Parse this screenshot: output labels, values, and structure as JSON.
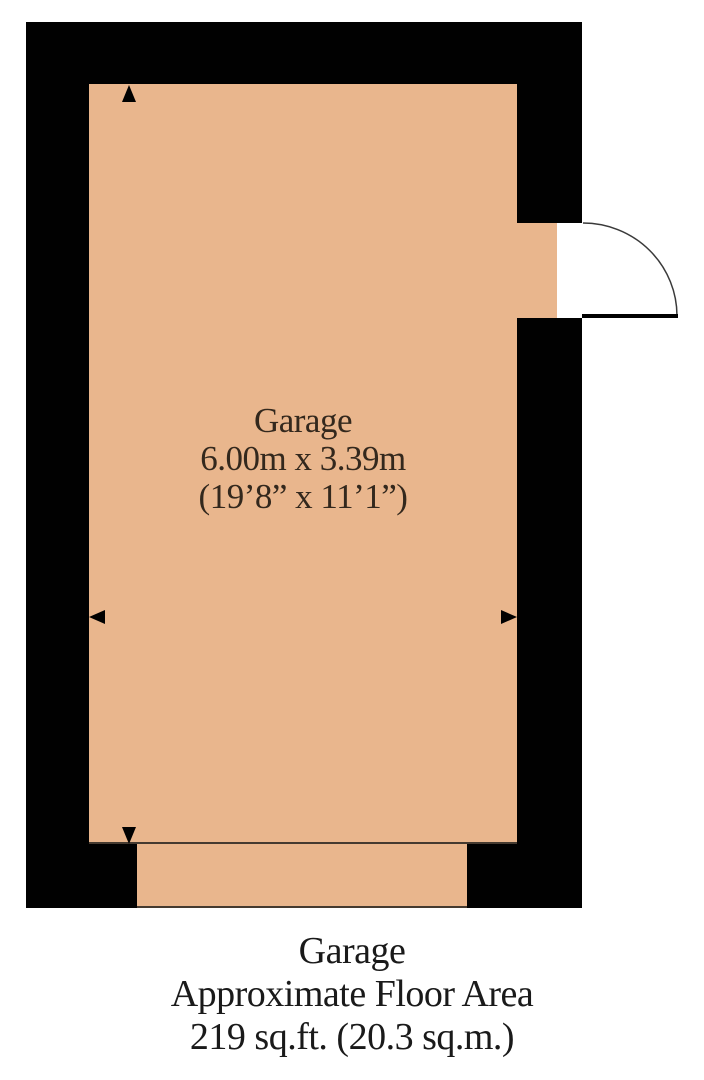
{
  "colors": {
    "floor": "#e9b68d",
    "wall": "#010101",
    "opening_line": "#453a30",
    "door_arc": "#3a3a3a",
    "room_label_text": "#33281d",
    "caption_text": "#1a1a1a"
  },
  "room_label": {
    "name": "Garage",
    "metric_dims": "6.00m x 3.39m",
    "imperial_dims": "(19’8” x 11’1”)"
  },
  "caption": {
    "room": "Garage",
    "subtitle": "Approximate Floor Area",
    "area": "219 sq.ft. (20.3 sq.m.)"
  }
}
